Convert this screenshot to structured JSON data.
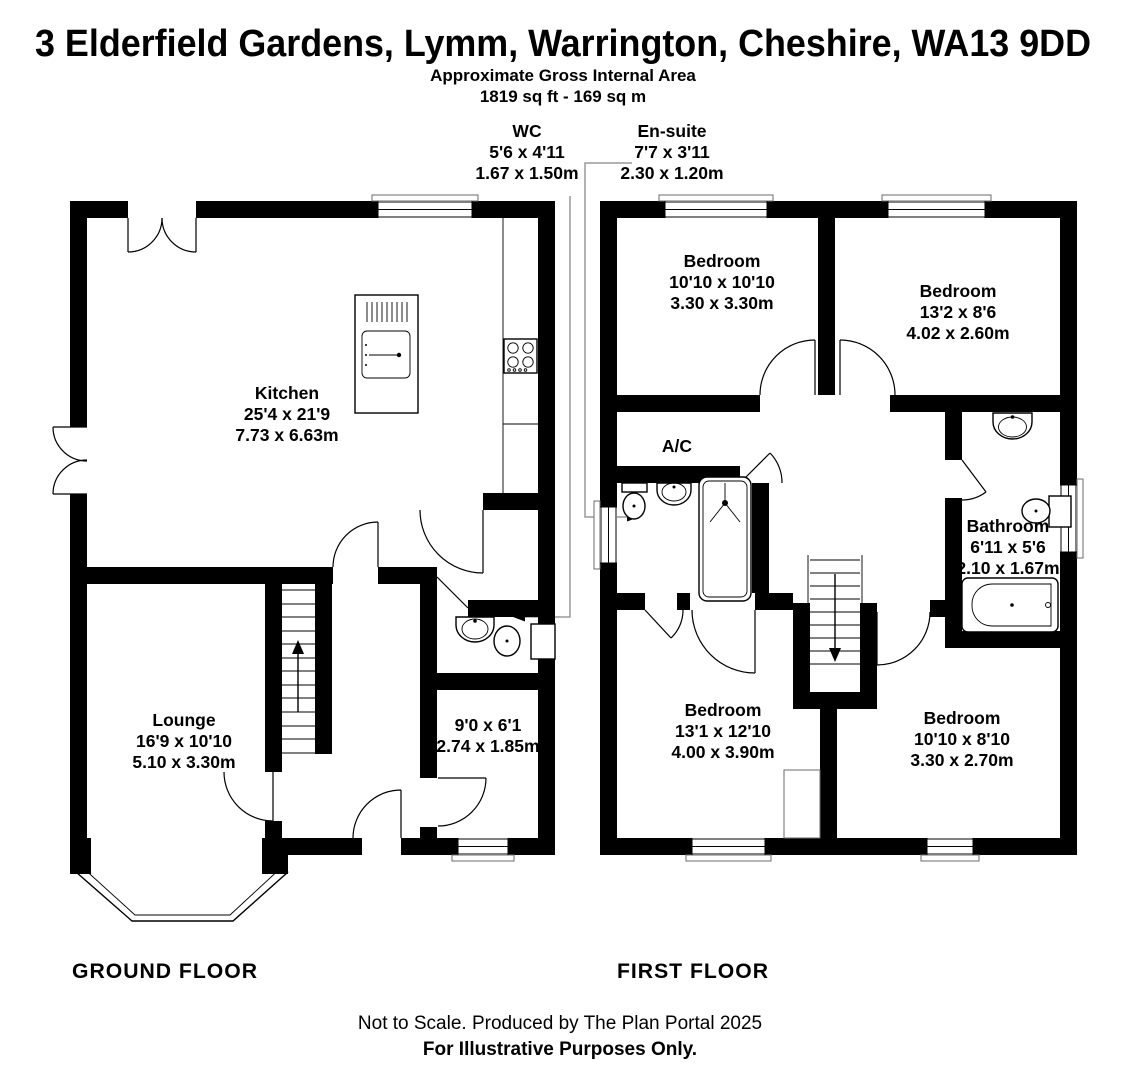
{
  "header": {
    "title": "3 Elderfield Gardens, Lymm, Warrington, Cheshire, WA13 9DD",
    "subtitle": "Approximate Gross Internal Area",
    "area": "1819 sq ft - 169 sq m"
  },
  "callouts": {
    "wc": {
      "name": "WC",
      "imperial": "5'6 x 4'11",
      "metric": "1.67 x 1.50m"
    },
    "ensuite": {
      "name": "En-suite",
      "imperial": "7'7 x 3'11",
      "metric": "2.30 x 1.20m"
    }
  },
  "ground_floor": {
    "title": "GROUND FLOOR",
    "rooms": {
      "kitchen": {
        "name": "Kitchen",
        "imperial": "25'4 x 21'9",
        "metric": "7.73 x 6.63m"
      },
      "lounge": {
        "name": "Lounge",
        "imperial": "16'9 x 10'10",
        "metric": "5.10 x 3.30m"
      },
      "store": {
        "imperial": "9'0 x 6'1",
        "metric": "2.74 x 1.85m"
      }
    }
  },
  "first_floor": {
    "title": "FIRST FLOOR",
    "rooms": {
      "bedroom1": {
        "name": "Bedroom",
        "imperial": "10'10 x 10'10",
        "metric": "3.30 x 3.30m"
      },
      "bedroom2": {
        "name": "Bedroom",
        "imperial": "13'2 x 8'6",
        "metric": "4.02 x 2.60m"
      },
      "ac": {
        "name": "A/C"
      },
      "bathroom": {
        "name": "Bathroom",
        "imperial": "6'11 x 5'6",
        "metric": "2.10 x 1.67m"
      },
      "bedroom3": {
        "name": "Bedroom",
        "imperial": "13'1 x 12'10",
        "metric": "4.00 x 3.90m"
      },
      "bedroom4": {
        "name": "Bedroom",
        "imperial": "10'10 x 8'10",
        "metric": "3.30 x 2.70m"
      }
    }
  },
  "footer": {
    "line1": "Not to Scale. Produced by The Plan Portal 2025",
    "line2": "For Illustrative Purposes Only."
  },
  "colors": {
    "walls": "#000000",
    "leader_lines": "#9a9a9a",
    "background": "#ffffff"
  }
}
